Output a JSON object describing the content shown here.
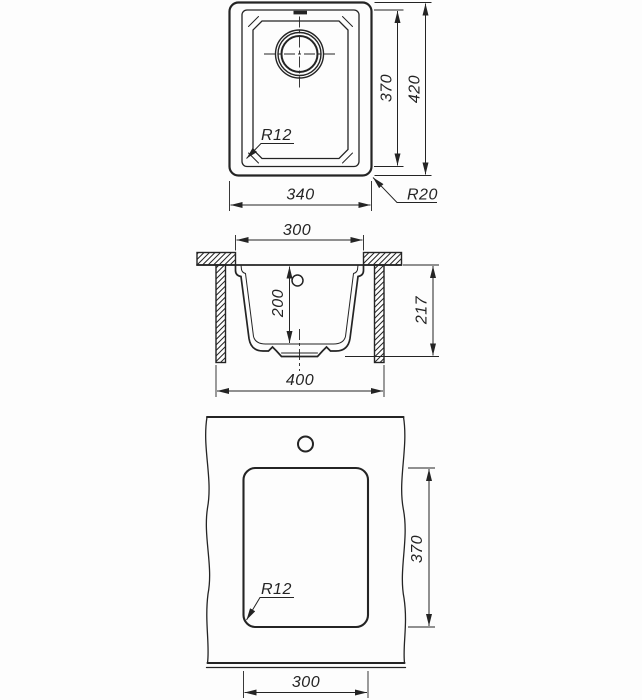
{
  "drawing": {
    "line_color": "#242424",
    "background": "#fdfdfd",
    "views": {
      "top": {
        "dims": {
          "width": "340",
          "bowl_height": "370",
          "overall_height": "420",
          "bowl_corner_radius": "R12",
          "outer_corner_radius": "R20"
        }
      },
      "section": {
        "dims": {
          "bowl_top_width": "300",
          "bowl_depth": "200",
          "overall_height": "217",
          "base_width": "400"
        }
      },
      "cutout": {
        "dims": {
          "cutout_height": "370",
          "cutout_width": "300",
          "cutout_corner_radius": "R12"
        }
      }
    }
  }
}
